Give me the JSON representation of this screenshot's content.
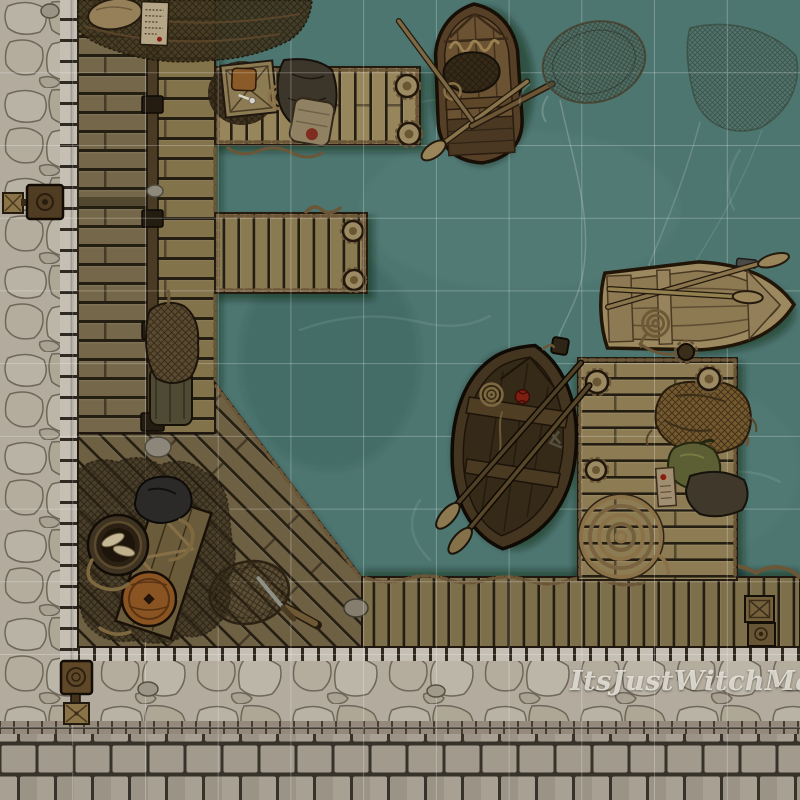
{
  "map": {
    "title": "fishing-docks-battle-map",
    "watermark": "ItsJustWitchMaps.",
    "grid": {
      "columns": 11,
      "rows": 11,
      "cell_size_px": 72.727,
      "line_color": "rgba(255,255,255,0.26)"
    },
    "colors": {
      "water": "#4d7670",
      "cobble": "#b2ab9e",
      "cobble_line": "#6e675a",
      "curb": "#c6c0b4",
      "paving": "#a29a8c",
      "brick": "#94897a",
      "plank_gap": "#241d12",
      "wood_spine_left": "#75684a",
      "wood_spine_right": "#83734b",
      "wood_pier_top": "#97855c",
      "wood_pier_mid": "#8a7a52",
      "wood_pier_right": "#8d7c53",
      "wood_south": "#7e6f4b",
      "wood_deck": "#6d6043",
      "rope": "#6b5638",
      "net_dark": "#41361f",
      "boat_dark_hull": "#563f27",
      "boat_light_hull": "#9d8960",
      "boat_black_hull": "#43351f",
      "sack_green": "#5c5e33",
      "barrel_orange": "#8a5422",
      "watermark": "rgba(242,240,233,0.8)"
    },
    "features": [
      {
        "name": "cobblestone-street",
        "where": "left edge and bottom band"
      },
      {
        "name": "paved-road",
        "where": "bottom edge"
      },
      {
        "name": "boardwalk-spine",
        "where": "left, vertical with rail beam"
      },
      {
        "name": "netting-covered-dock-corner",
        "where": "top of boardwalk, with sack and notice"
      },
      {
        "name": "upper-pier",
        "where": "top, with crate, pipe, rope coil, tarp, bedroll, mooring posts"
      },
      {
        "name": "middle-pier",
        "where": "center-left, with mooring posts"
      },
      {
        "name": "diagonal-deck",
        "where": "bottom-left, with barrels, nets, plank sheet, hand net, knife"
      },
      {
        "name": "south-dock",
        "where": "bottom, with stacked crates"
      },
      {
        "name": "right-pier",
        "where": "right, with net pile, green sack, tarp, rope spiral"
      },
      {
        "name": "rowboat-with-net-cargo",
        "where": "top center, oars crossed"
      },
      {
        "name": "light-rowboat",
        "where": "right, moored, oars crossed"
      },
      {
        "name": "dark-rowboat",
        "where": "center, oars and anchor rope"
      },
      {
        "name": "drifting-fishing-net",
        "where": "top right water"
      },
      {
        "name": "dip-net",
        "where": "floating near top rowboat"
      },
      {
        "name": "winch-post",
        "where": "left curb"
      },
      {
        "name": "mooring-post-with-box",
        "where": "bottom-left curb"
      }
    ]
  }
}
